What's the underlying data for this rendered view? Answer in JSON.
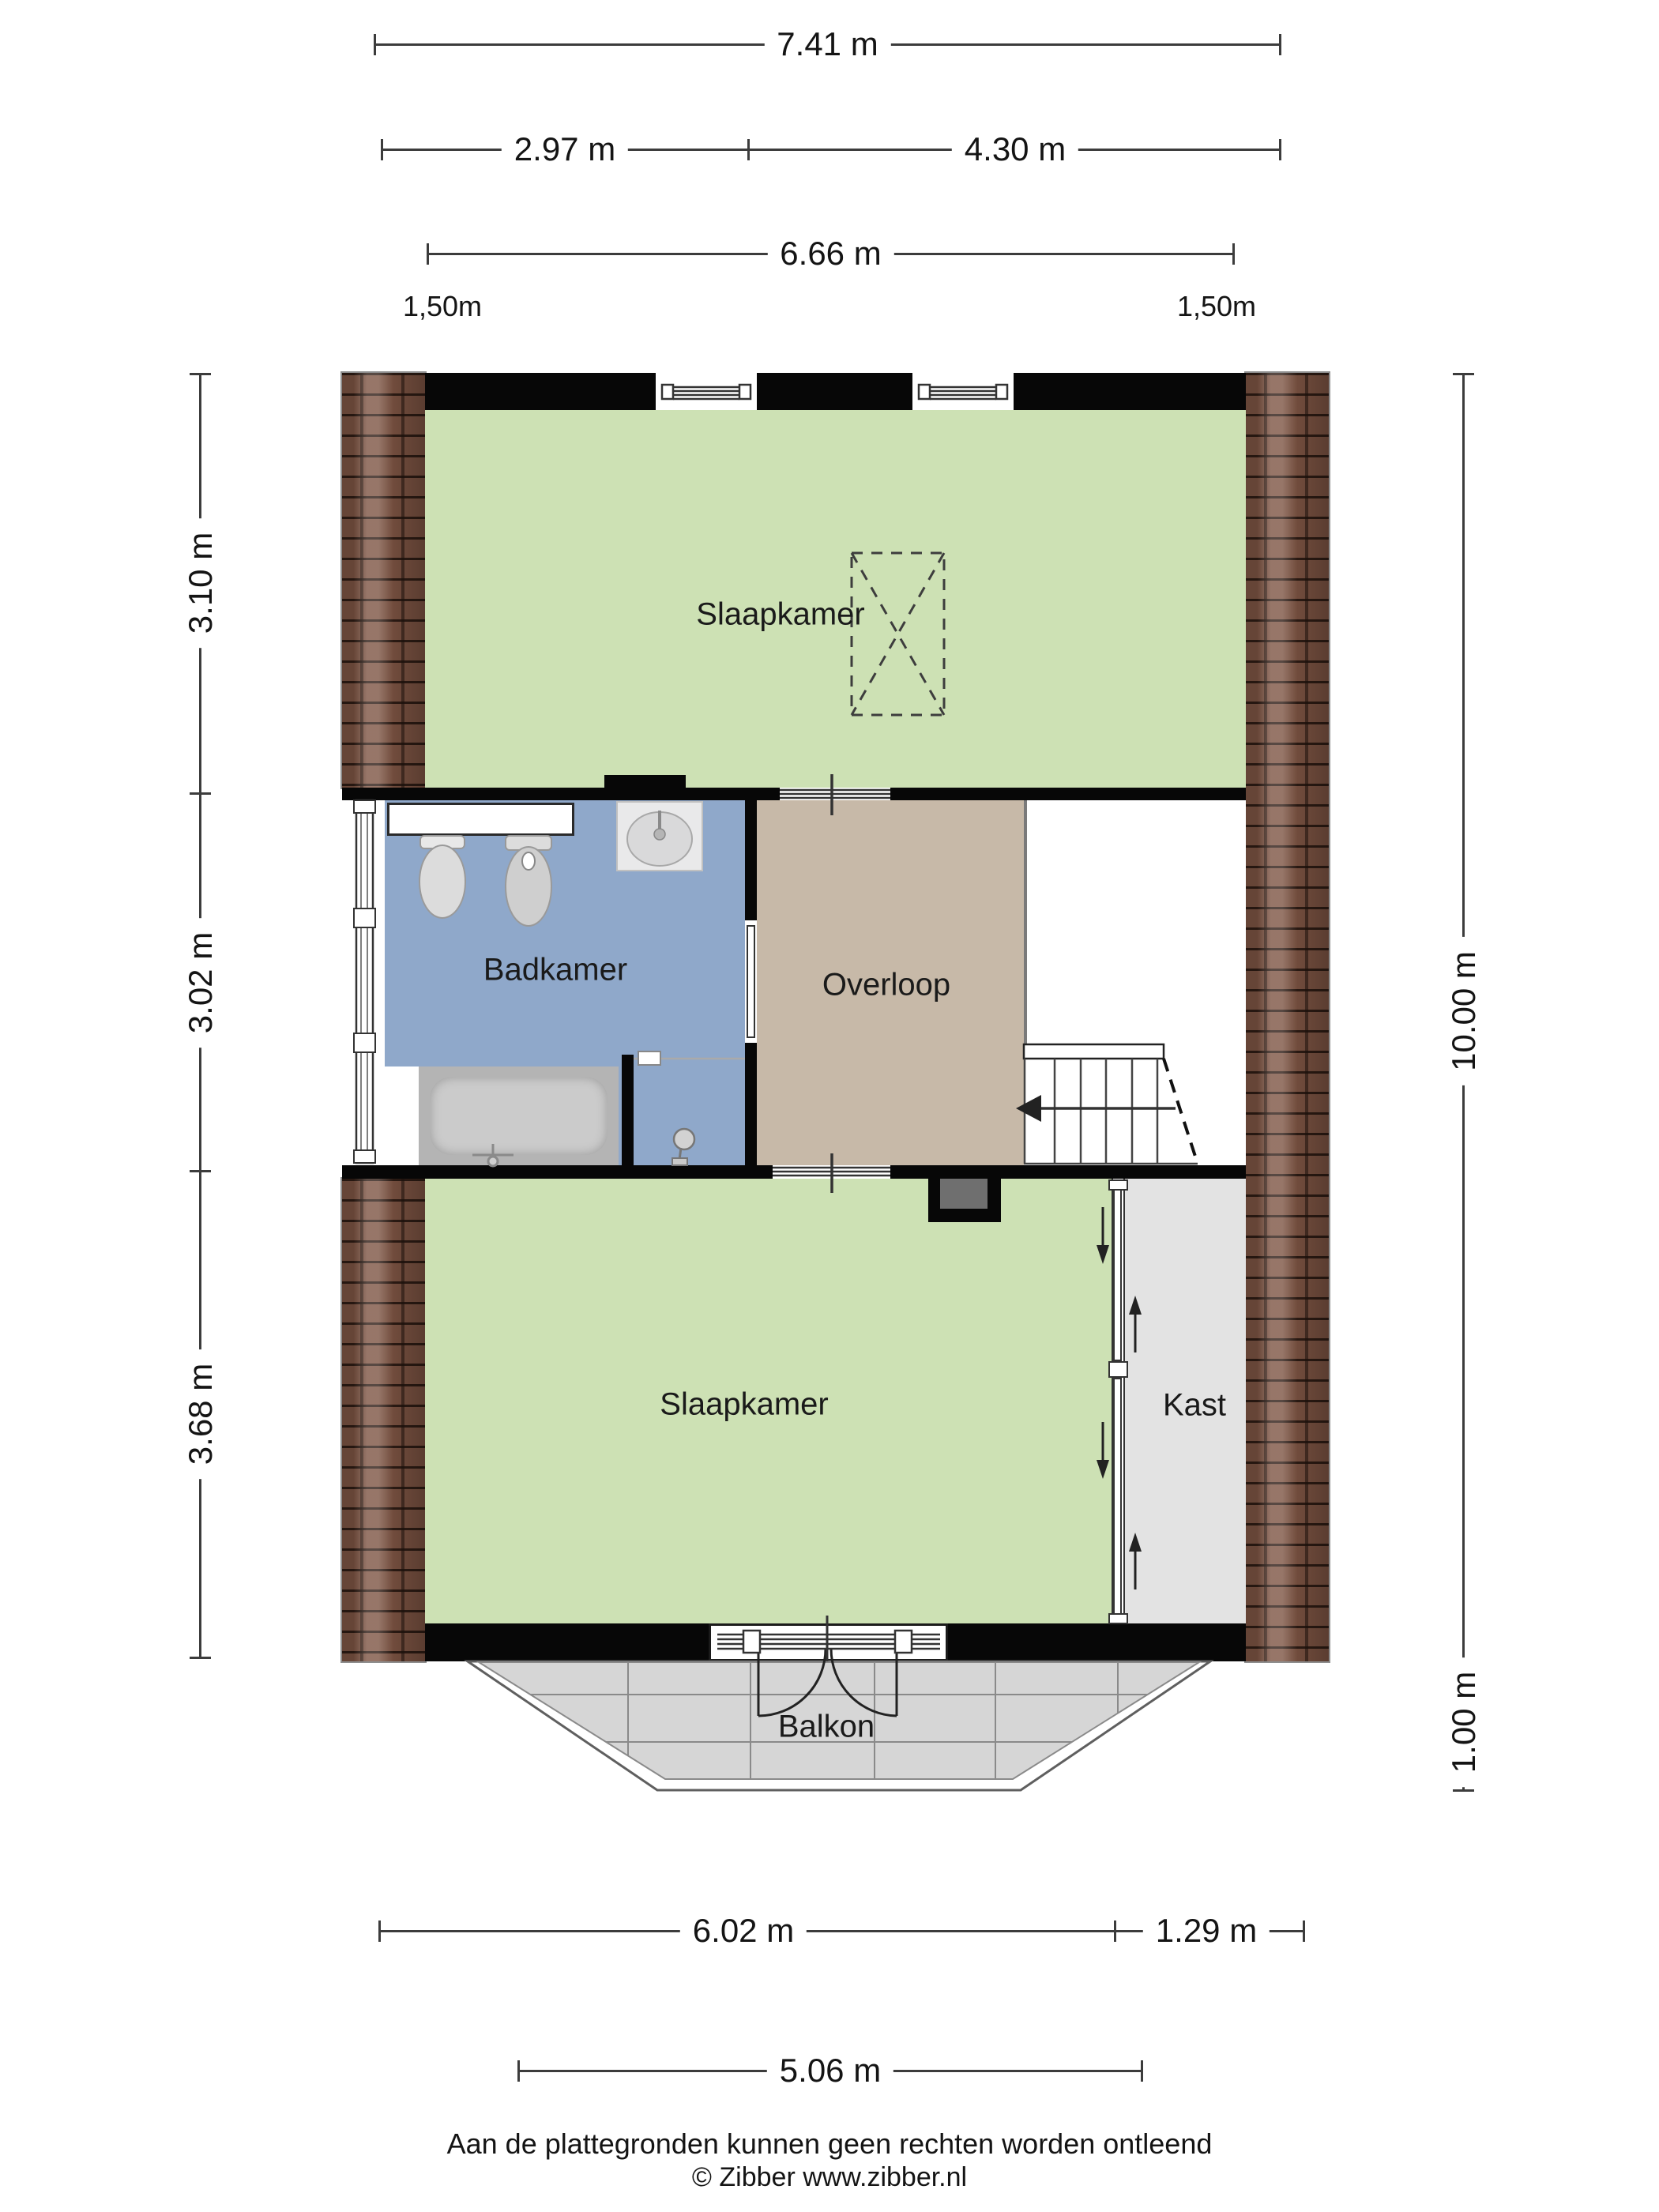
{
  "dims": {
    "total_width": "7.41 m",
    "left_width": "2.97 m",
    "right_width": "4.30 m",
    "inner_width": "6.66 m",
    "eave_left": "1,50m",
    "eave_right": "1,50m",
    "top_height": "3.10 m",
    "mid_height": "3.02 m",
    "bottom_height": "3.68 m",
    "total_height": "10.00 m",
    "balcony_depth": "1.00 m",
    "bottom_main_width": "6.02 m",
    "bottom_closet_width": "1.29 m",
    "balcony_width": "5.06 m"
  },
  "rooms": {
    "bedroom_top": "Slaapkamer",
    "bathroom": "Badkamer",
    "landing": "Overloop",
    "bedroom_bottom": "Slaapkamer",
    "closet": "Kast",
    "balcony": "Balkon"
  },
  "footer": {
    "disclaimer": "Aan de plattegronden kunnen geen rechten worden ontleend",
    "credit": "© Zibber www.zibber.nl"
  },
  "colors": {
    "floor_green": "#cde1b4",
    "bathroom_blue": "#8fa8ca",
    "landing_tan": "#c7b9a8",
    "closet_gray": "#e3e3e3",
    "balcony_gray": "#d6d6d6",
    "brick_brown": "#7d5443",
    "wall_black": "#070707"
  }
}
